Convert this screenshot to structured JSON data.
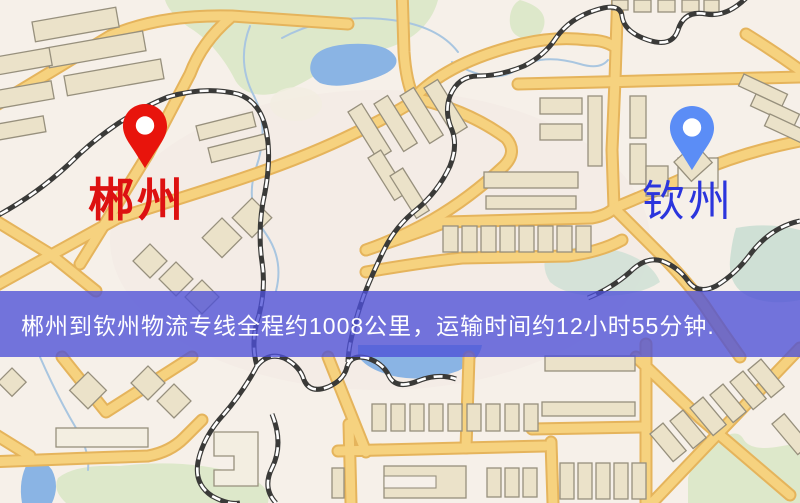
{
  "banner": {
    "text": "郴州到钦州物流专线全程约1008公里，运输时间约12小时55分钟.",
    "bg": "rgba(77,79,215,0.78)",
    "text_color": "#ffffff"
  },
  "pins": {
    "origin": {
      "label": "郴州",
      "pin_color": "#e8140c",
      "label_color": "#dd1111"
    },
    "destination": {
      "label": "钦州",
      "pin_color": "#5b8df6",
      "label_color": "#2b35dd"
    }
  },
  "map": {
    "colors": {
      "bg": "#f6f0e9",
      "tint": "#f3eae4",
      "green": "#dde8ca",
      "green-teal": "#cfe0d5",
      "water": "#8ab4e4",
      "water-line": "#a9c6e0",
      "road-casing": "#e5b45c",
      "road-fill": "#f6d27f",
      "building-fill": "#ebe2c9",
      "building-stroke": "#97907d",
      "building-light": "#f3eee1",
      "rail-dark": "#3a3a38",
      "rail-light": "#ffffff"
    }
  }
}
